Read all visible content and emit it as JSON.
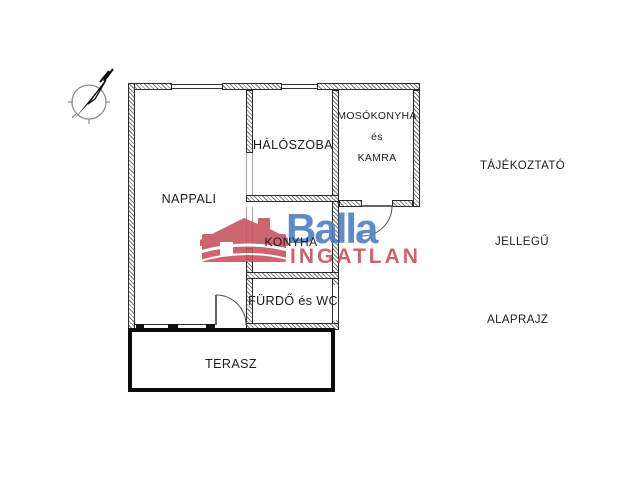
{
  "brand": {
    "name": "Balla",
    "subtitle": "INGATLAN",
    "blue": "#4a7cc2",
    "red": "#c94f57"
  },
  "rooms": {
    "nappali": "NAPPALI",
    "haloszoba": "HÁLÓSZOBA",
    "mosokonyha_line1": "MOSÓKONYHA",
    "mosokonyha_line2": "és",
    "mosokonyha_line3": "KAMRA",
    "konyha": "KONYHA",
    "furdo": "FÜRDŐ és WC",
    "terasz": "TERASZ"
  },
  "side_text": {
    "line1": "TÁJÉKOZTATÓ",
    "line2": "JELLEGŰ",
    "line3": "ALAPRAJZ"
  },
  "icons": {
    "compass": "north-compass",
    "house": "balla-house-logo"
  }
}
